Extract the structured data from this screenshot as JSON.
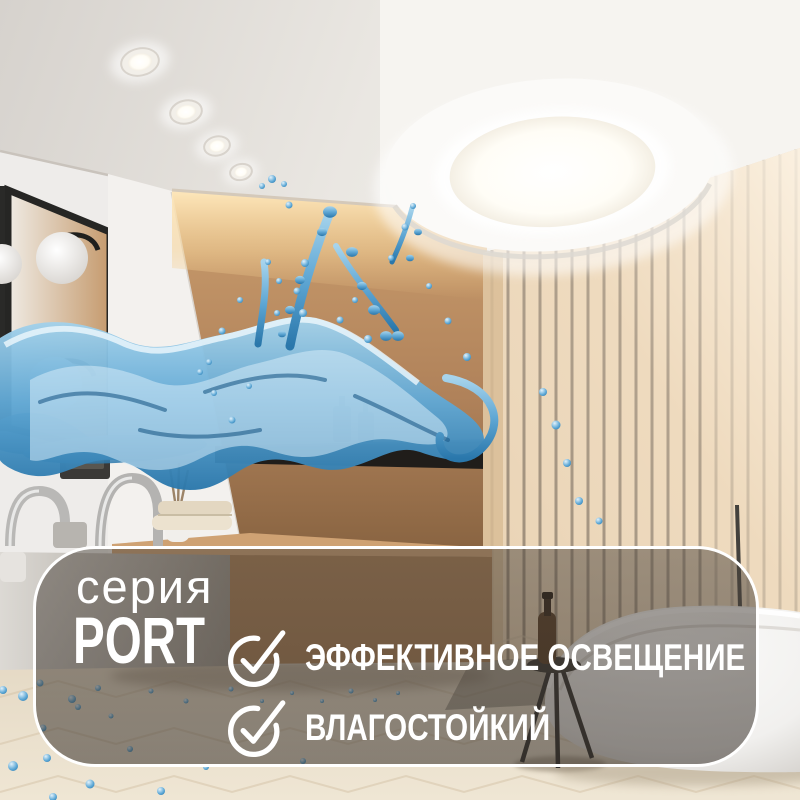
{
  "panel": {
    "series_label": "серия",
    "series_name": "PORT",
    "features": [
      {
        "icon": "check-circle-icon",
        "label": "ЭФФЕКТИВНОЕ ОСВЕЩЕНИЕ"
      },
      {
        "icon": "check-circle-icon",
        "label": "ВЛАГОСТОЙКИЙ"
      }
    ],
    "colors": {
      "border": "#ffffff",
      "fill": "rgba(66,60,54,0.5)",
      "text": "#ffffff"
    }
  },
  "scene": {
    "description": "bathroom interior: recessed round LED downlight in ceiling, water splash, vanity with faucets and towels, black-framed mirror with sphere lamps, warm backlit wall, wood slat partition, freestanding bathtub with black tripod stool",
    "colors": {
      "water": "#2e86c1",
      "wood_slats": "#e9d2b2",
      "wall_tan": "#b5825a",
      "cove_light": "#f5d9a8",
      "ceiling": "#efece8"
    }
  }
}
